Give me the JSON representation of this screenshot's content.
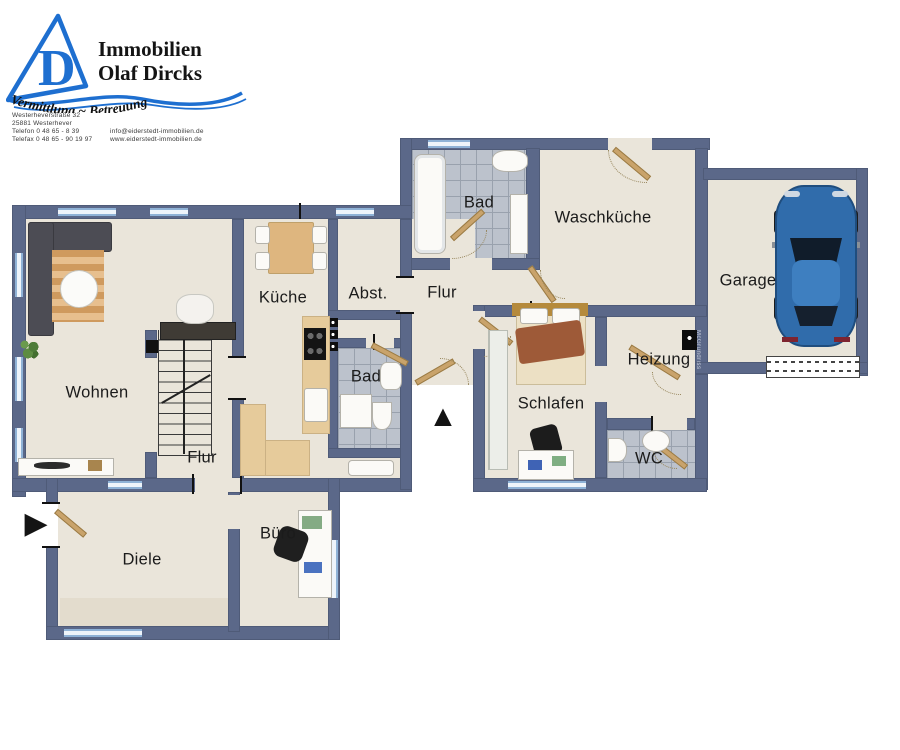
{
  "logo": {
    "company_line1": "Immobilien",
    "company_line2": "Olaf Dircks",
    "monogram": "D",
    "slogan": "Vermittlung ~ Betreuung",
    "address_lines": [
      "Westerheverstraße 32",
      "25881 Westerhever",
      "Telefon 0 48 65 - 8 39",
      "Telefax 0 48 65 - 90 19 97"
    ],
    "contact_lines": [
      "info@eiderstedt-immobilien.de",
      "www.eiderstedt-immobilien.de"
    ],
    "brand_blue": "#1e6fd0"
  },
  "plan": {
    "watermark": "McGrundriss",
    "icons": {
      "entrance_arrow": "▶",
      "north_arrow": "▲"
    },
    "colors": {
      "wall": "#5b6889",
      "floor": "#eae5da",
      "tiles": "#bcc2cc",
      "window": "#d9e6f3",
      "door_wood": "#c9a36b",
      "outside": "#ffffff",
      "car": "#306cab"
    },
    "rooms": [
      {
        "id": "wohnen",
        "label": "Wohnen"
      },
      {
        "id": "flur_eg",
        "label": "Flur"
      },
      {
        "id": "kueche",
        "label": "Küche"
      },
      {
        "id": "abstellraum",
        "label": "Abst."
      },
      {
        "id": "flur_mitte",
        "label": "Flur"
      },
      {
        "id": "bad_klein",
        "label": "Bad"
      },
      {
        "id": "bad_gross",
        "label": "Bad"
      },
      {
        "id": "waschkueche",
        "label": "Waschküche"
      },
      {
        "id": "garage",
        "label": "Garage"
      },
      {
        "id": "schlafen",
        "label": "Schlafen"
      },
      {
        "id": "heizung",
        "label": "Heizung"
      },
      {
        "id": "wc",
        "label": "WC"
      },
      {
        "id": "diele",
        "label": "Diele"
      },
      {
        "id": "buero",
        "label": "Büro"
      }
    ]
  }
}
